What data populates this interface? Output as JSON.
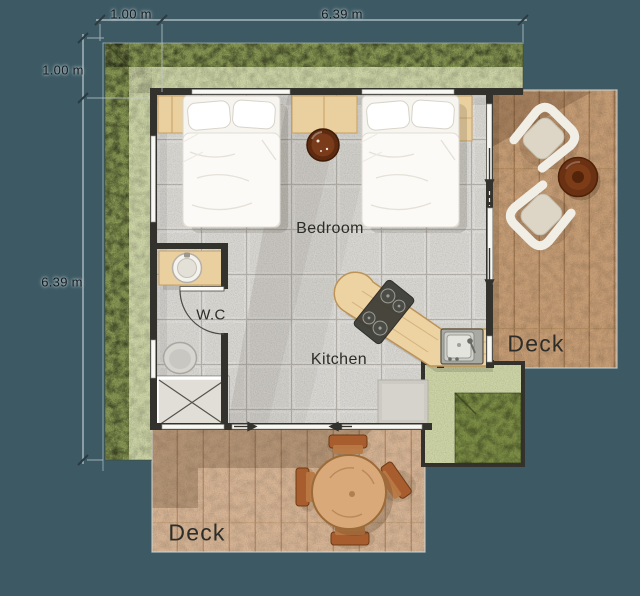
{
  "title": "Tiny house floor plan",
  "dims": {
    "top_small": "1.00 m",
    "top_large": "6.39 m",
    "left_small": "1.00 m",
    "left_large": "6.39 m"
  },
  "rooms": {
    "bedroom": "Bedroom",
    "wc": "W.C",
    "kitchen": "Kitchen",
    "deck_right": "Deck",
    "deck_bottom": "Deck"
  },
  "palette": {
    "background": "#3d5a64",
    "grass_dark": "#8a9a55",
    "grass_light": "#cdd4a6",
    "wall": "#34322c",
    "floor_tile": "#d9d7d2",
    "deck_wood_right": "#c79e76",
    "deck_wood_bottom": "#d7b595",
    "counter_wood": "#edd3a2",
    "dimension_line": "#bfcbd0",
    "dimension_text": "#14181b",
    "label_text": "#2d2d28"
  },
  "furniture": [
    "double-bed",
    "double-bed",
    "nightstand",
    "planter",
    "wardrobe",
    "wardrobe",
    "washbasin",
    "toilet",
    "shower",
    "wc-door",
    "kitchen-counter",
    "gas-stove",
    "kitchen-sink",
    "appliance",
    "dining-table",
    "dining-chair",
    "dining-chair",
    "dining-chair",
    "dining-chair",
    "armchair",
    "armchair",
    "coffee-table"
  ]
}
